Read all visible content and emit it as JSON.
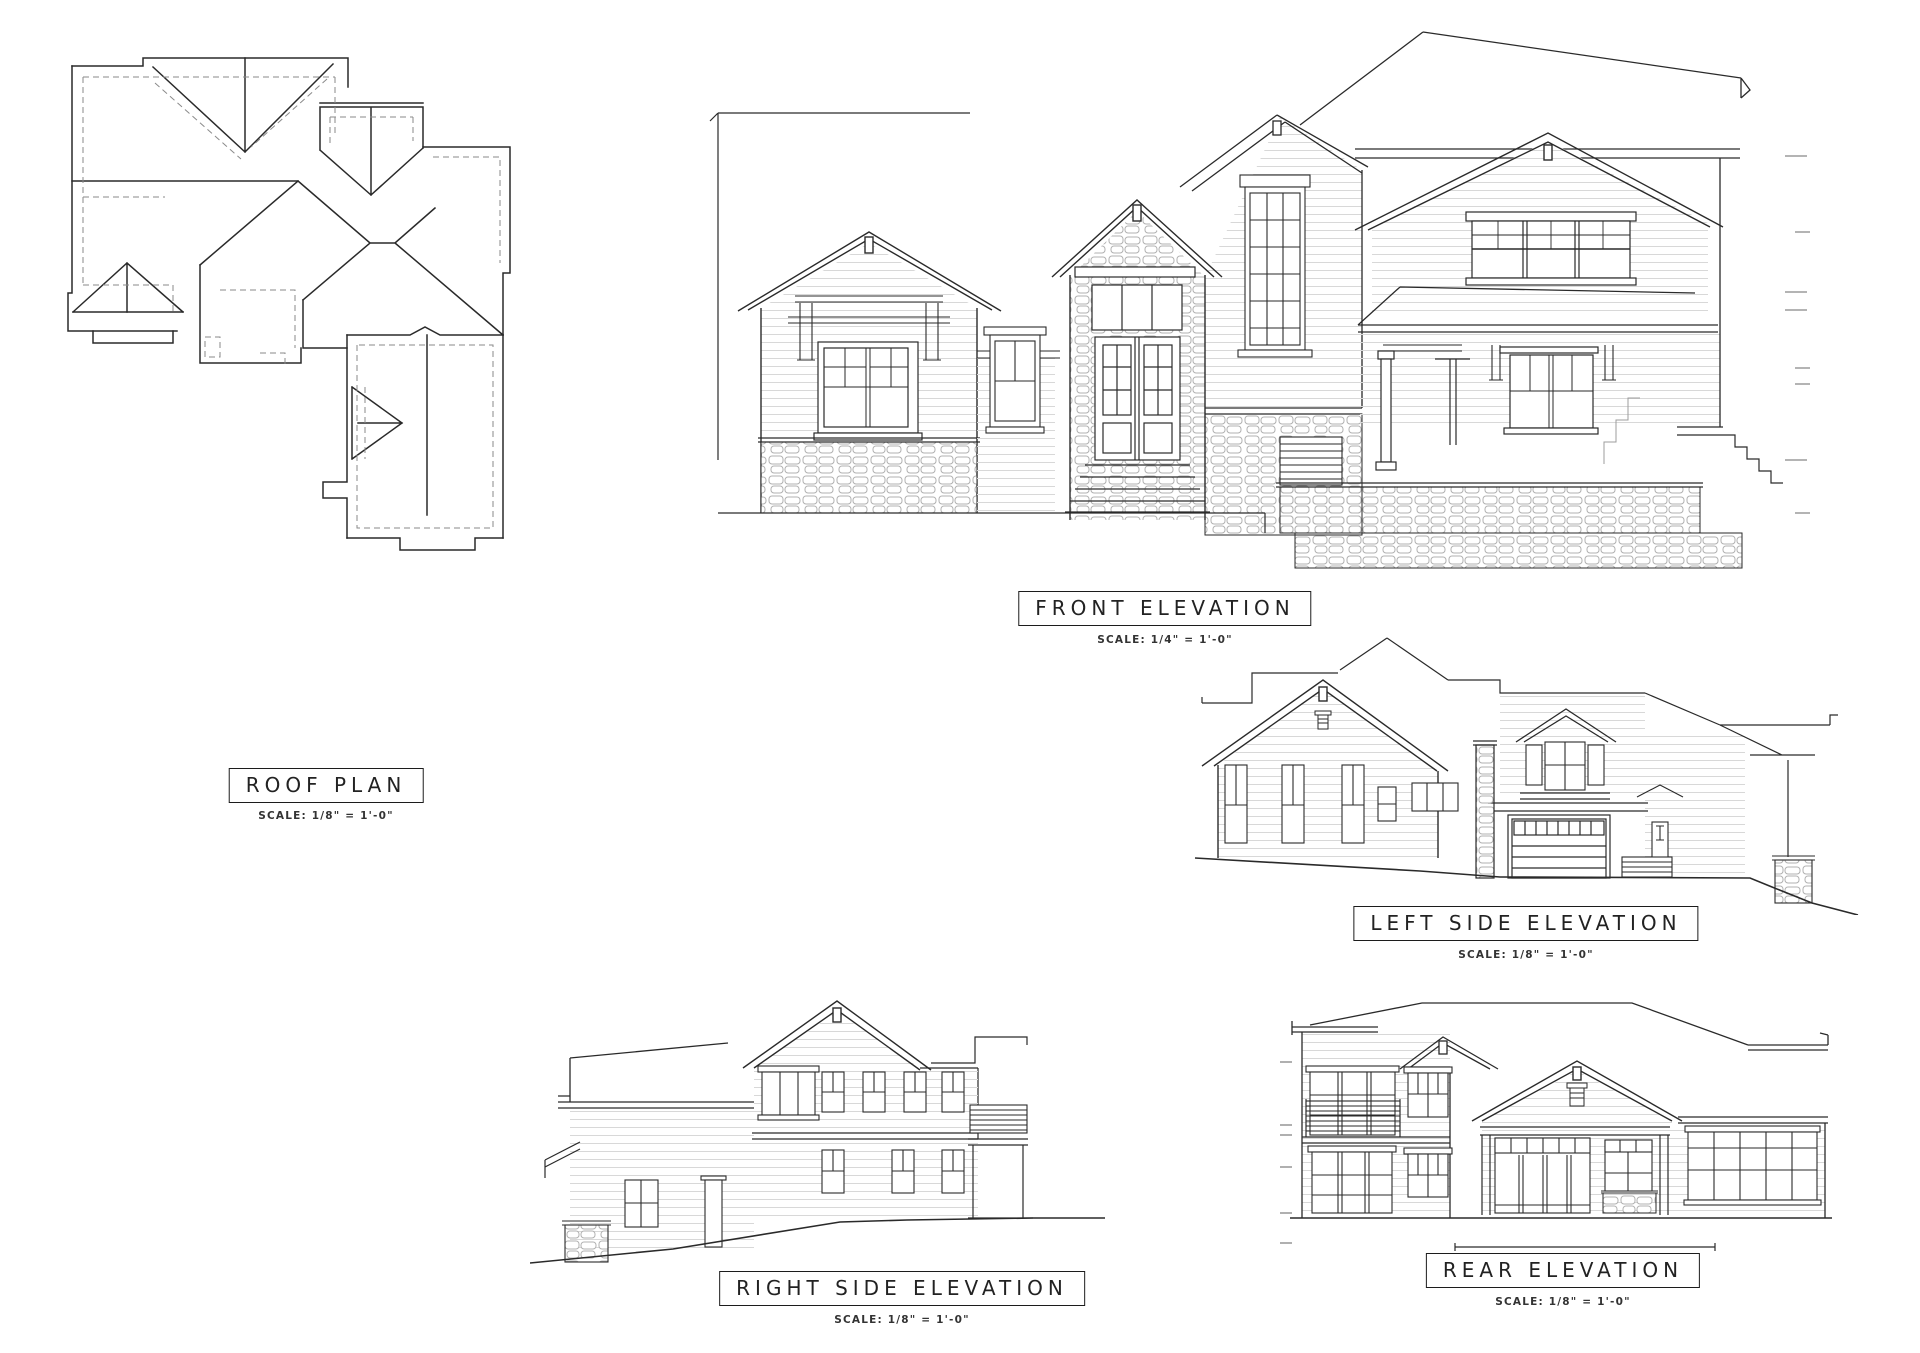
{
  "sheet": {
    "background_color": "#ffffff",
    "line_color": "#2a2a2a",
    "hidden_line_color": "#8a8a8a",
    "datum_tick_color": "#9c9c9c",
    "siding_line_color": "#d8d8d8",
    "stone_line_color": "#b0b0b0"
  },
  "drawings": {
    "roof_plan": {
      "title": "ROOF PLAN",
      "scale": "SCALE:  1/8\" = 1'-0\""
    },
    "front_elevation": {
      "title": "FRONT ELEVATION",
      "scale": "SCALE:  1/4\" = 1'-0\""
    },
    "left_side_elevation": {
      "title": "LEFT SIDE ELEVATION",
      "scale": "SCALE:  1/8\" = 1'-0\""
    },
    "right_side_elevation": {
      "title": "RIGHT SIDE ELEVATION",
      "scale": "SCALE:  1/8\" = 1'-0\""
    },
    "rear_elevation": {
      "title": "REAR ELEVATION",
      "scale": "SCALE:  1/8\" = 1'-0\""
    }
  }
}
